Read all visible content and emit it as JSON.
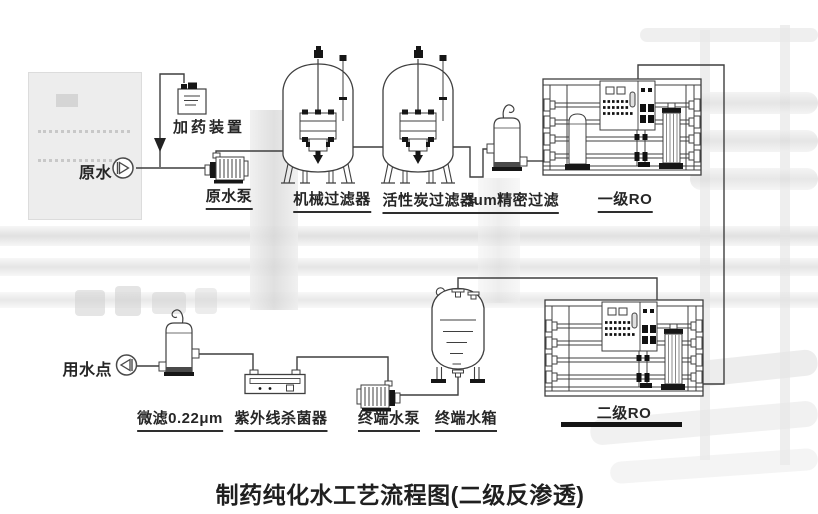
{
  "title": "制药纯化水工艺流程图(二级反渗透)",
  "nodes": {
    "raw_water": "原水",
    "dosing_device": "加药装置",
    "raw_water_pump": "原水泵",
    "mechanical_filter": "机械过滤器",
    "carbon_filter": "活性炭过滤器",
    "precision_filter": "5um精密过滤",
    "stage1_ro": "一级RO",
    "stage2_ro": "二级RO",
    "terminal_tank": "终端水箱",
    "terminal_pump": "终端水泵",
    "uv_sterilizer": "紫外线杀菌器",
    "micro_filter": "微滤0.22μm",
    "use_point": "用水点"
  },
  "process_sequence": [
    "原水",
    "加药装置",
    "原水泵",
    "机械过滤器",
    "活性炭过滤器",
    "5um精密过滤",
    "一级RO",
    "二级RO",
    "终端水箱",
    "终端水泵",
    "紫外线杀菌器",
    "微滤0.22μm",
    "用水点"
  ],
  "colors": {
    "line": "#3f3f3f",
    "accent_black": "#161616",
    "label": "#262626",
    "underline": "#2e2e2e",
    "background": "#ffffff"
  }
}
